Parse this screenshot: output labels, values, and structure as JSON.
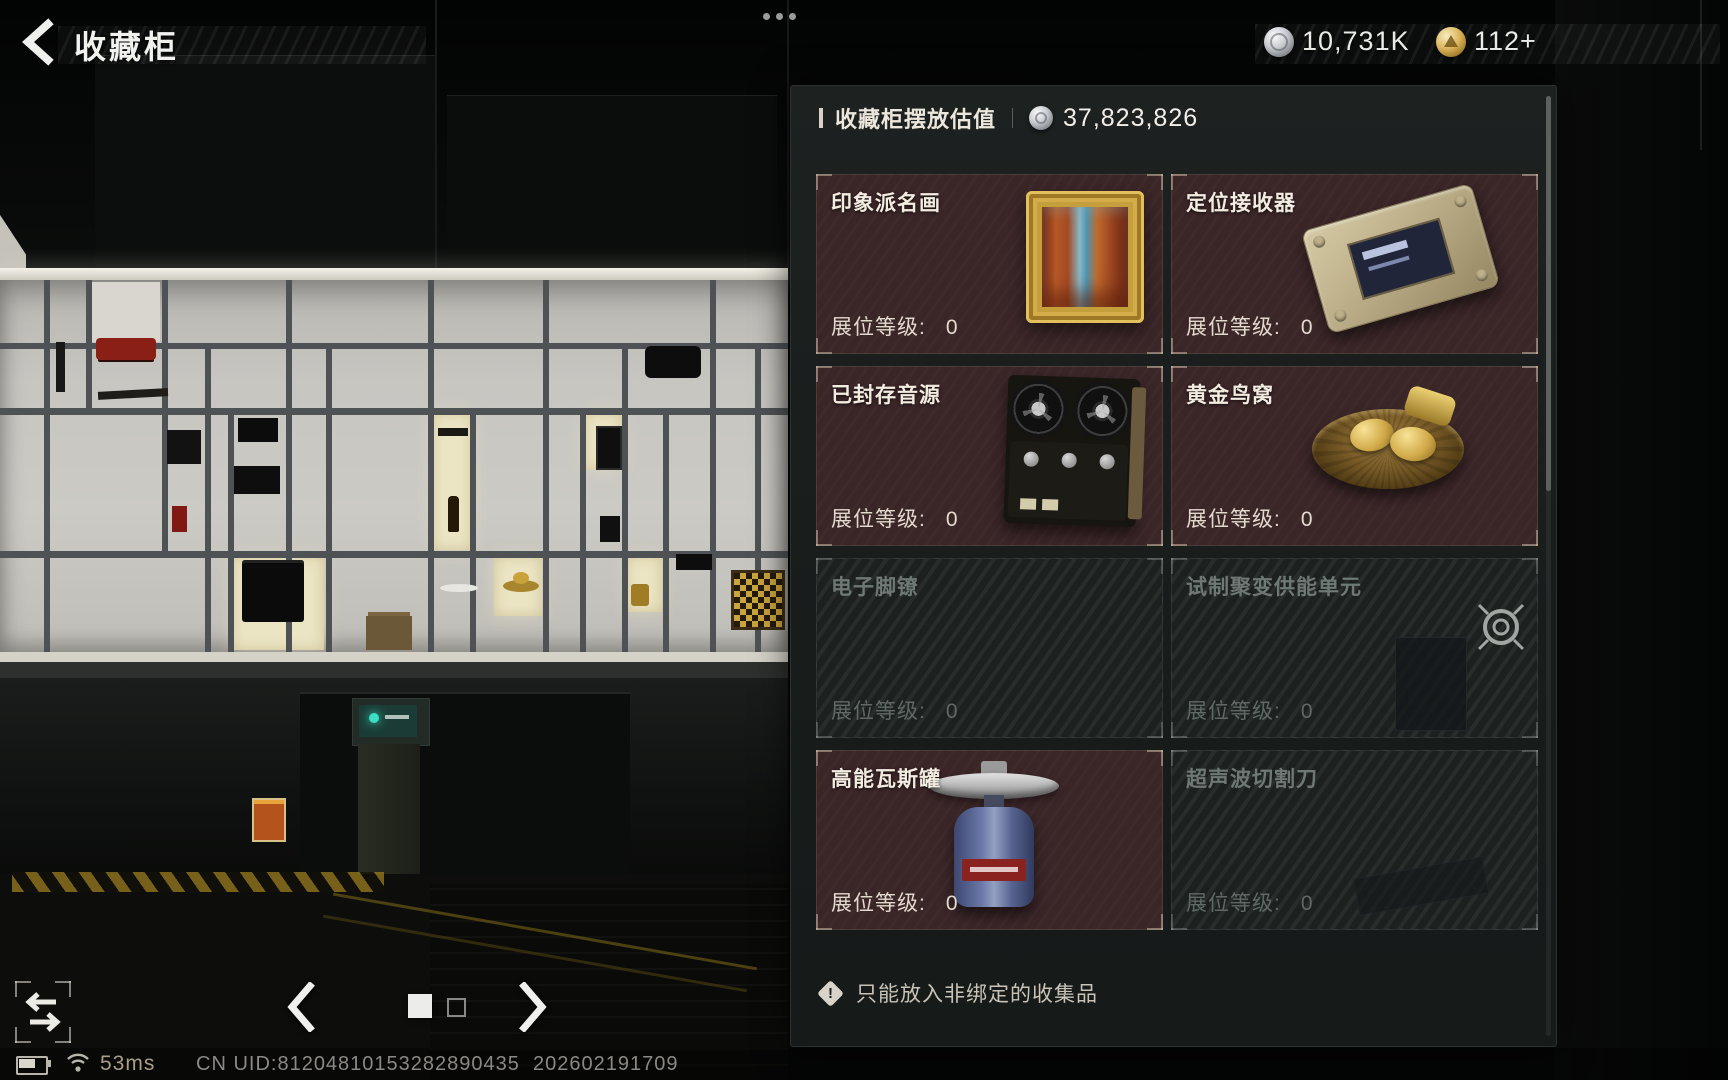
{
  "header": {
    "title": "收藏柜",
    "currencies": [
      {
        "icon": "silver-coin",
        "value": "10,731K"
      },
      {
        "icon": "gold-coin",
        "value": "112+"
      }
    ]
  },
  "panel": {
    "valuation_label": "收藏柜摆放估值",
    "valuation_value": "37,823,826",
    "level_label": "展位等级:",
    "items": [
      {
        "name": "印象派名画",
        "level": "0",
        "locked": false,
        "image": "framed-painting"
      },
      {
        "name": "定位接收器",
        "level": "0",
        "locked": false,
        "image": "positioning-receiver"
      },
      {
        "name": "已封存音源",
        "level": "0",
        "locked": false,
        "image": "reel-tape-recorder"
      },
      {
        "name": "黄金鸟窝",
        "level": "0",
        "locked": false,
        "image": "golden-egg-nest"
      },
      {
        "name": "电子脚镣",
        "level": "0",
        "locked": true,
        "image": ""
      },
      {
        "name": "试制聚变供能单元",
        "level": "0",
        "locked": true,
        "image": "locate-reticle-badge"
      },
      {
        "name": "高能瓦斯罐",
        "level": "0",
        "locked": false,
        "image": "gas-canister"
      },
      {
        "name": "超声波切割刀",
        "level": "0",
        "locked": true,
        "image": ""
      }
    ],
    "warning": "只能放入非绑定的收集品"
  },
  "carousel": {
    "total_pages": 2,
    "current_page": 1
  },
  "status_bar": {
    "ping": "53ms",
    "server_info": "CN UID:81204810153282890435  202602191709"
  }
}
